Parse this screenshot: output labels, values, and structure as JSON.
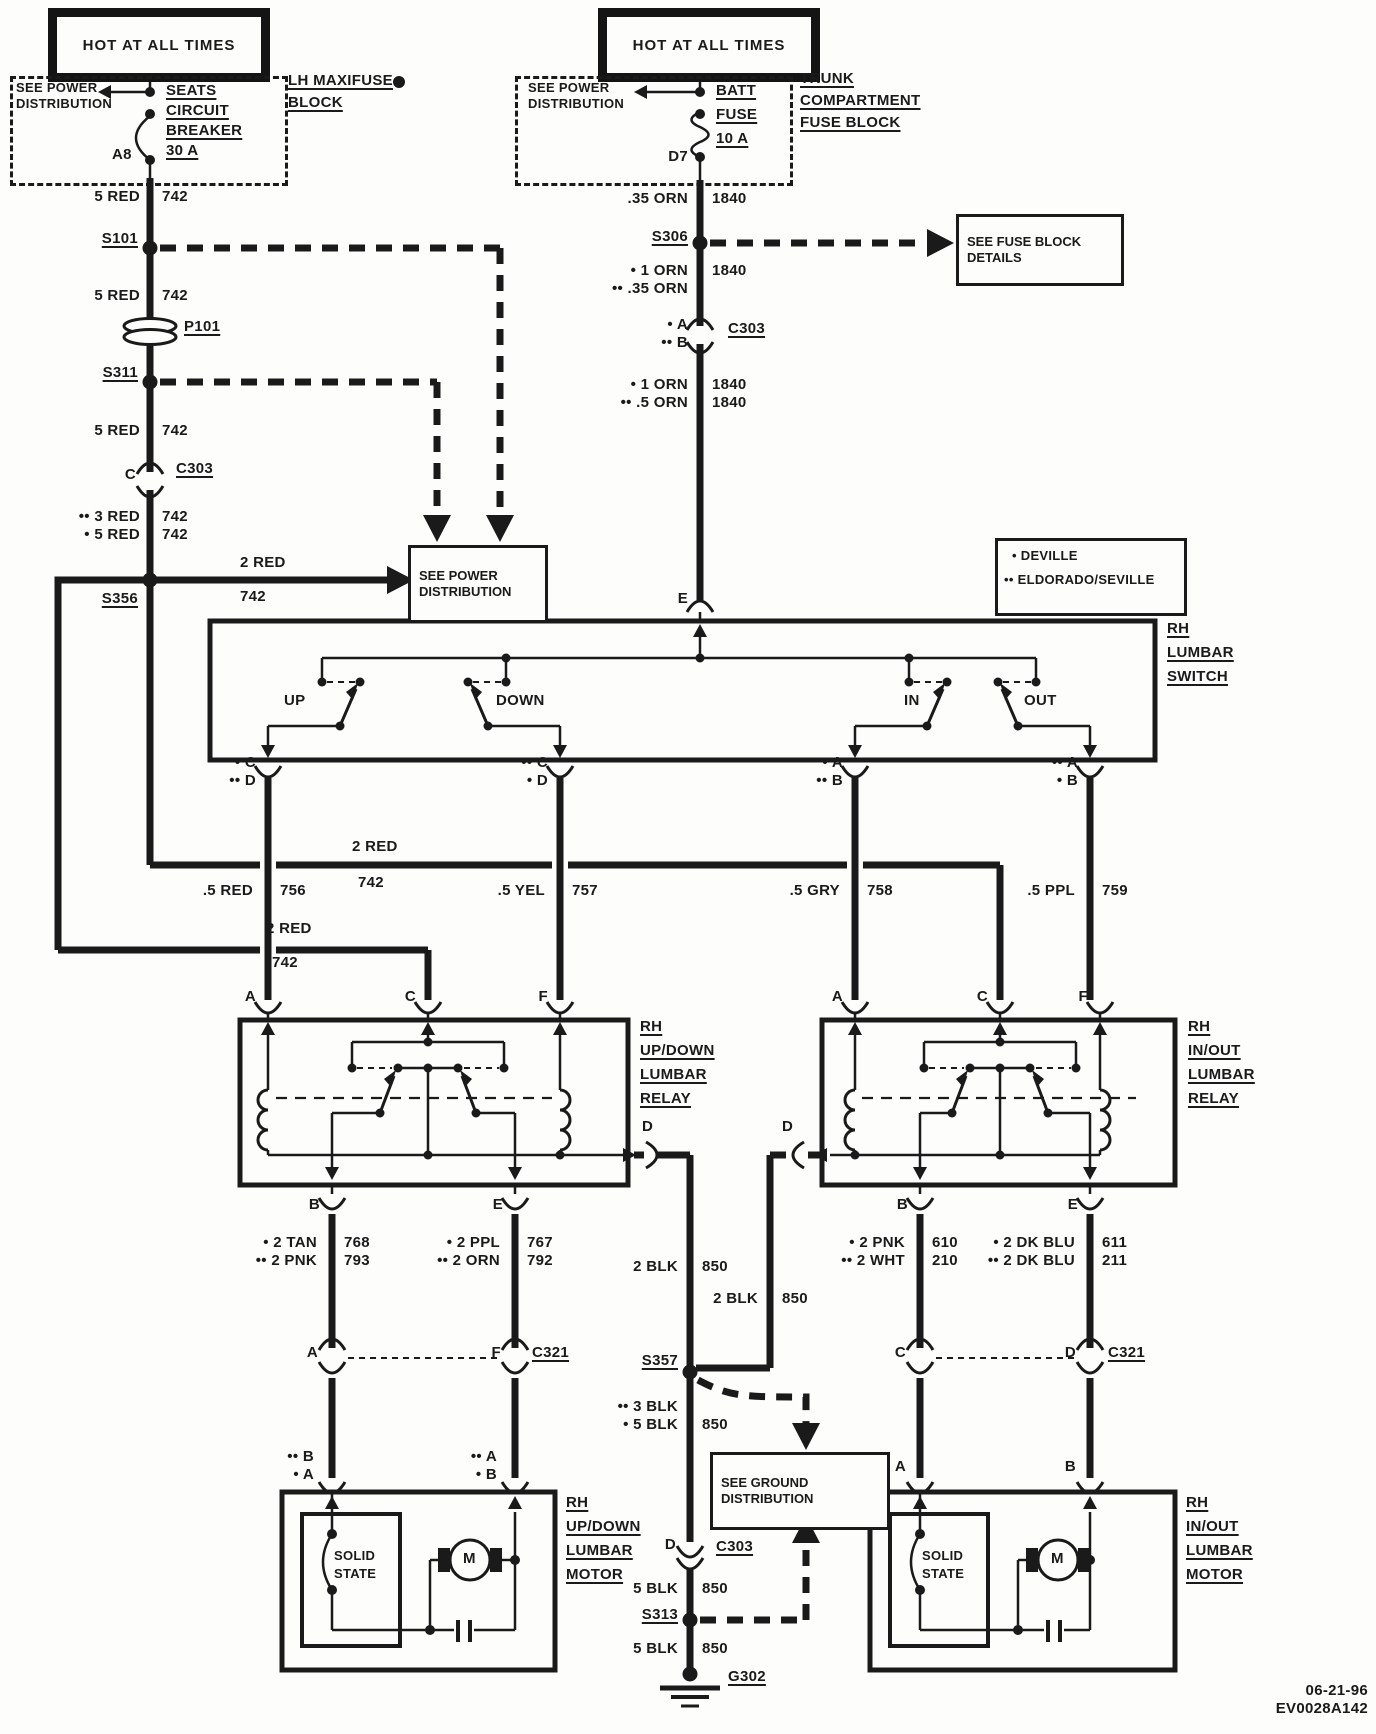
{
  "header": {
    "hot_left": "HOT AT ALL TIMES",
    "hot_right": "HOT AT ALL TIMES"
  },
  "left_feed": {
    "see_power": "SEE POWER DISTRIBUTION",
    "breaker_l1": "SEATS",
    "breaker_l2": "CIRCUIT",
    "breaker_l3": "BREAKER",
    "breaker_l4": "30 A",
    "pin": "A8",
    "block_l1": "LH MAXIFUSE",
    "block_l2": "BLOCK",
    "seg1_size": "5 RED",
    "seg1_ckt": "742",
    "s101": "S101",
    "seg2_size": "5 RED",
    "seg2_ckt": "742",
    "p101": "P101",
    "s311": "S311",
    "seg3_size": "5 RED",
    "seg3_ckt": "742",
    "c303_pin": "C",
    "c303": "C303",
    "seg4a_size": "•• 3 RED",
    "seg4a_ckt": "742",
    "seg4b_size": "• 5 RED",
    "seg4b_ckt": "742",
    "s356": "S356",
    "branch_size": "2 RED",
    "branch_ckt": "742",
    "see_power_box": "SEE POWER DISTRIBUTION"
  },
  "right_feed": {
    "see_power": "SEE POWER DISTRIBUTION",
    "fuse_l1": "BATT",
    "fuse_l2": "FUSE",
    "fuse_l3": "10 A",
    "pin": "D7",
    "block_l1": "TRUNK",
    "block_l2": "COMPARTMENT",
    "block_l3": "FUSE BLOCK",
    "seg1_size": ".35 ORN",
    "seg1_ckt": "1840",
    "s306": "S306",
    "see_fuse_box": "SEE FUSE BLOCK DETAILS",
    "seg2a_size": "• 1 ORN",
    "seg2a_ckt": "1840",
    "seg2b_size": "•• .35 ORN",
    "c303_pin_a": "• A",
    "c303_pin_b": "•• B",
    "c303": "C303",
    "seg3a_size": "• 1 ORN",
    "seg3a_ckt": "1840",
    "seg3b_size": "•• .5 ORN",
    "seg3b_ckt": "1840",
    "pin_e": "E"
  },
  "legend": {
    "item1": "• DEVILLE",
    "item2": "•• ELDORADO/SEVILLE"
  },
  "lumbar_switch": {
    "name_l1": "RH",
    "name_l2": "LUMBAR",
    "name_l3": "SWITCH",
    "up": "UP",
    "down": "DOWN",
    "in": "IN",
    "out": "OUT",
    "up_pin1": "• C",
    "up_pin2": "•• D",
    "down_pin1": "•• C",
    "down_pin2": "• D",
    "in_pin1": "• A",
    "in_pin2": "•• B",
    "out_pin1": "•• A",
    "out_pin2": "• B"
  },
  "bus": {
    "size": "2 RED",
    "ckt": "742"
  },
  "bus2": {
    "size": "2 RED",
    "ckt": "742"
  },
  "switch_outputs": {
    "up_size": ".5 RED",
    "up_ckt": "756",
    "down_size": ".5 YEL",
    "down_ckt": "757",
    "in_size": ".5 GRY",
    "in_ckt": "758",
    "out_size": ".5 PPL",
    "out_ckt": "759"
  },
  "relay_left": {
    "name_l1": "RH",
    "name_l2": "UP/DOWN",
    "name_l3": "LUMBAR",
    "name_l4": "RELAY",
    "pin_a": "A",
    "pin_c": "C",
    "pin_f": "F",
    "pin_b": "B",
    "pin_e": "E",
    "pin_d": "D"
  },
  "relay_right": {
    "name_l1": "RH",
    "name_l2": "IN/OUT",
    "name_l3": "LUMBAR",
    "name_l4": "RELAY",
    "pin_a": "A",
    "pin_c": "C",
    "pin_f": "F",
    "pin_b": "B",
    "pin_e": "E",
    "pin_d": "D"
  },
  "relay_left_outputs": {
    "b1_size": "• 2 TAN",
    "b1_ckt": "768",
    "b2_size": "•• 2 PNK",
    "b2_ckt": "793",
    "e1_size": "• 2 PPL",
    "e1_ckt": "767",
    "e2_size": "•• 2 ORN",
    "e2_ckt": "792"
  },
  "relay_right_outputs": {
    "b1_size": "• 2 PNK",
    "b1_ckt": "610",
    "b2_size": "•• 2 WHT",
    "b2_ckt": "210",
    "e1_size": "• 2 DK BLU",
    "e1_ckt": "611",
    "e2_size": "•• 2 DK BLU",
    "e2_ckt": "211"
  },
  "ground": {
    "left_size": "2 BLK",
    "left_ckt": "850",
    "right_size": "2 BLK",
    "right_ckt": "850",
    "s357": "S357",
    "seg2a": "•• 3 BLK",
    "seg2b": "• 5 BLK",
    "seg2_ckt": "850",
    "see_ground_box": "SEE GROUND DISTRIBUTION",
    "c303_pin": "D",
    "c303": "C303",
    "seg3_size": "5 BLK",
    "seg3_ckt": "850",
    "s313": "S313",
    "seg4_size": "5 BLK",
    "seg4_ckt": "850",
    "g302": "G302"
  },
  "c321_left": {
    "pin_a": "A",
    "pin_f": "F",
    "name": "C321",
    "motor1_pin1": "•• B",
    "motor1_pin2": "• A",
    "motor2_pin1": "•• A",
    "motor2_pin2": "• B"
  },
  "c321_right": {
    "pin_c": "C",
    "pin_d": "D",
    "name": "C321",
    "motor1_pin": "A",
    "motor2_pin": "B"
  },
  "motor_left": {
    "solid_l1": "SOLID",
    "solid_l2": "STATE",
    "m": "M",
    "name_l1": "RH",
    "name_l2": "UP/DOWN",
    "name_l3": "LUMBAR",
    "name_l4": "MOTOR"
  },
  "motor_right": {
    "solid_l1": "SOLID",
    "solid_l2": "STATE",
    "m": "M",
    "name_l1": "RH",
    "name_l2": "IN/OUT",
    "name_l3": "LUMBAR",
    "name_l4": "MOTOR"
  },
  "footer": {
    "date": "06-21-96",
    "code": "EV0028A142"
  }
}
